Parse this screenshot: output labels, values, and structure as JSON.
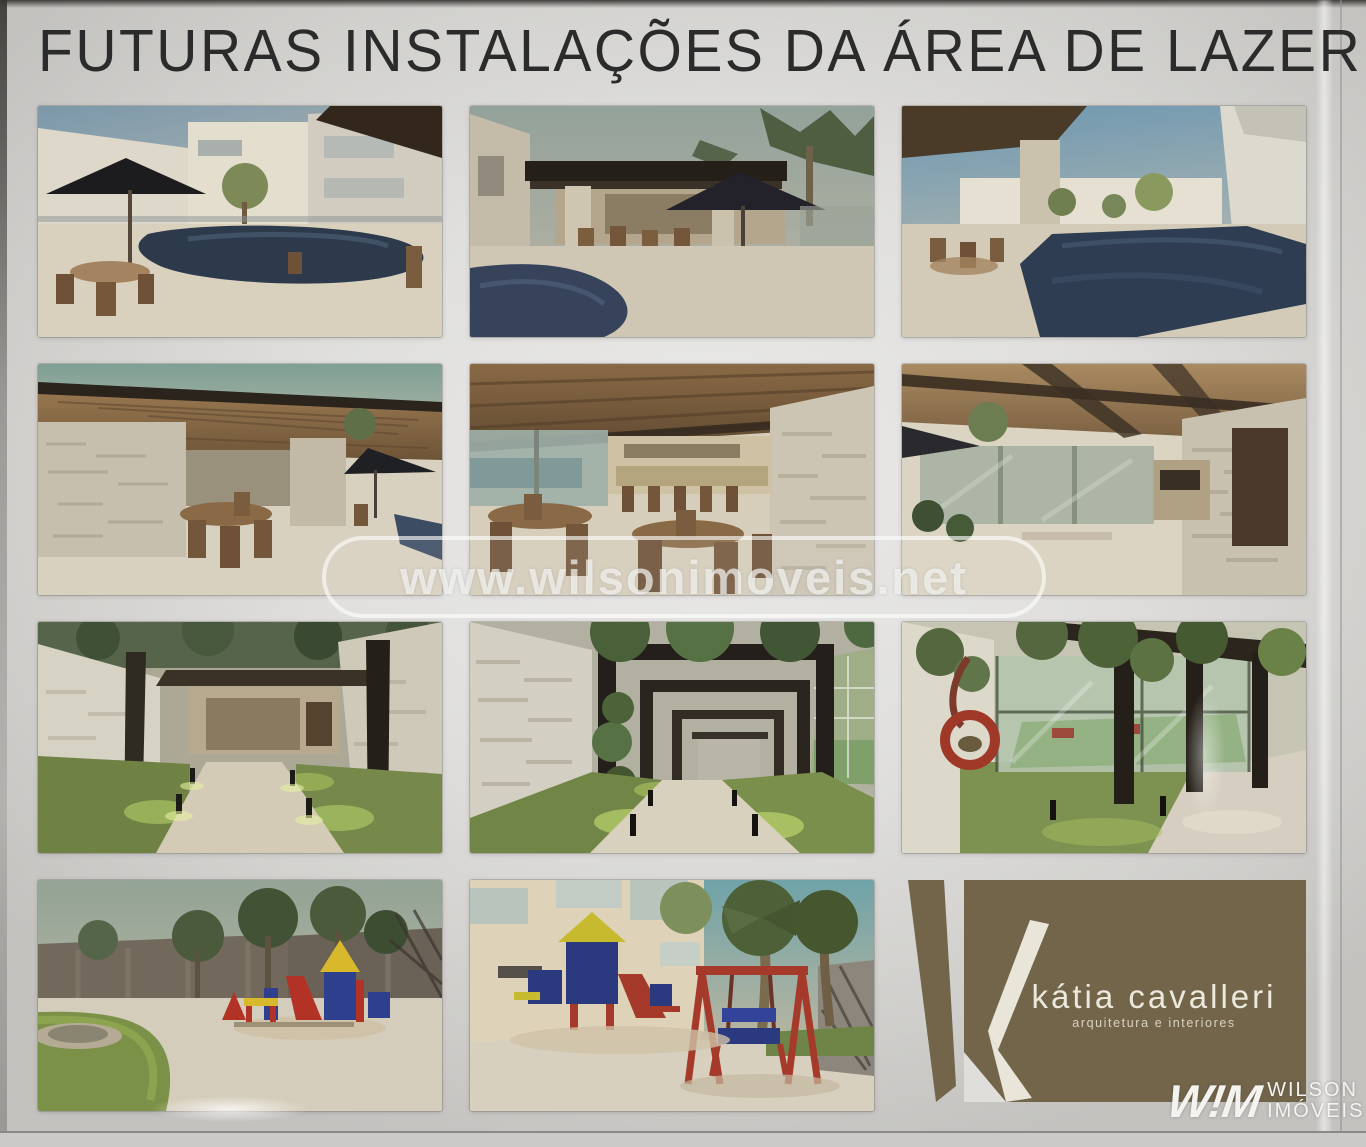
{
  "header": {
    "title": "FUTURAS INSTALAÇÕES DA ÁREA DE LAZER"
  },
  "watermark": {
    "url_text": "www.wilsonimoveis.net"
  },
  "gallery": {
    "tile_names": [
      "pool-terrace-dusk-rendering",
      "pool-pavilion-umbrella-rendering",
      "lap-pool-building-rendering",
      "gourmet-terrace-stone-pillars-rendering",
      "gourmet-lounge-tables-bar-rendering",
      "gourmet-area-glass-wall-door-rendering",
      "garden-walkway-lit-path-rendering",
      "pergola-walkway-vines-rendering",
      "sports-court-tire-swing-rendering",
      "playground-palms-rendering",
      "playground-swings-tower-rendering",
      "architect-logo-card"
    ]
  },
  "logo_card": {
    "brand": "kátia cavalleri",
    "tagline": "arquitetura e interiores",
    "bg_color": "#72654a"
  },
  "footer_logo": {
    "monogram": "W!M",
    "line1": "WILSON",
    "line2": "IMÓVEIS"
  },
  "colors": {
    "board_background": "#dddcda",
    "title_text": "#2b2b2b",
    "watermark_text": "#fafaf8",
    "pool_water": "#2f3d52",
    "deck": "#d6cdbb",
    "wood_ceiling": "#8a6b49",
    "stone_wall": "#c9c1b0",
    "grass": "#75894a",
    "pergola_dark": "#2a241d",
    "play_red": "#a53a2a",
    "play_blue": "#2b3a7e",
    "play_yellow": "#cdb82c"
  }
}
